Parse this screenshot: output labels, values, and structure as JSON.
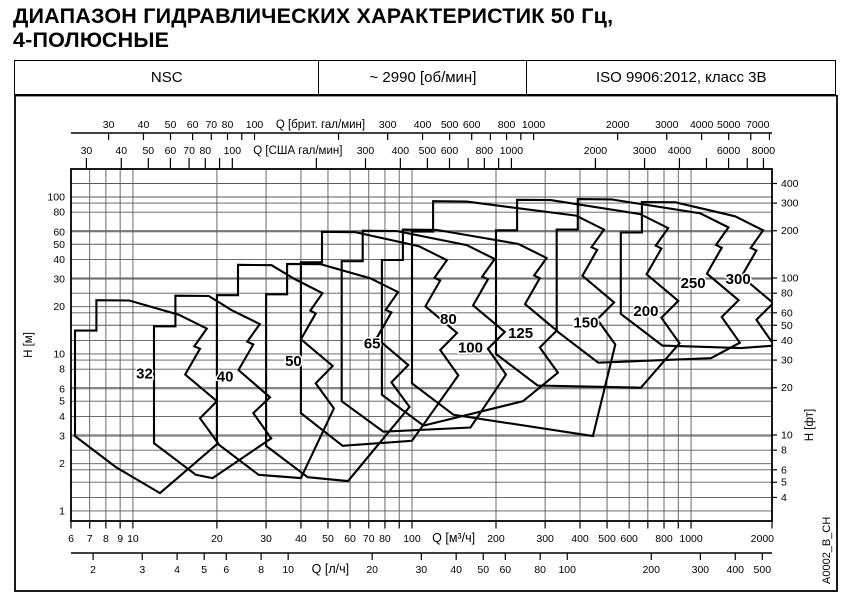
{
  "title": {
    "line1": "ДИАПАЗОН ГИДРАВЛИЧЕСКИХ ХАРАКТЕРИСТИК 50 Гц,",
    "line2": "4-ПОЛЮСНЫЕ"
  },
  "header": {
    "model": "NSC",
    "speed": "~ 2990 [об/мин]",
    "standard": "ISO 9906:2012, класс 3В"
  },
  "side_code": "A0002_B_CH",
  "colors": {
    "line": "#000000",
    "grid": "#5a5a5a",
    "bg": "#ffffff"
  },
  "chart_data": {
    "type": "area",
    "description": "Pump performance range envelopes, flow Q vs head H, log-log",
    "x_range_m3h": [
      6,
      1950
    ],
    "y_range_m": [
      0.863,
      150.8
    ],
    "flow_scales": [
      {
        "id": "imp_gpm",
        "label": "Q [брит. гал/мин]",
        "to_m3h": 0.27276,
        "side": "top",
        "row": 0,
        "title_at_m3h": 47,
        "ticks": [
          30,
          40,
          50,
          60,
          70,
          80,
          90,
          100,
          200,
          300,
          400,
          500,
          600,
          700,
          800,
          900,
          1000,
          2000,
          3000,
          4000,
          5000,
          6000,
          7000
        ],
        "labels": [
          30,
          40,
          50,
          60,
          70,
          80,
          100,
          300,
          400,
          500,
          600,
          800,
          1000,
          2000,
          3000,
          4000,
          5000,
          7000
        ]
      },
      {
        "id": "us_gpm",
        "label": "Q [США гал/мин]",
        "to_m3h": 0.22712,
        "side": "top",
        "row": 1,
        "title_at_m3h": 39,
        "ticks": [
          30,
          40,
          50,
          60,
          70,
          80,
          90,
          100,
          200,
          300,
          400,
          500,
          600,
          700,
          800,
          900,
          1000,
          2000,
          3000,
          4000,
          5000,
          6000,
          7000,
          8000
        ],
        "labels": [
          30,
          40,
          50,
          60,
          70,
          80,
          100,
          300,
          400,
          500,
          600,
          800,
          1000,
          2000,
          3000,
          4000,
          6000,
          8000
        ]
      },
      {
        "id": "m3h",
        "label": "Q [м³/ч]",
        "to_m3h": 1,
        "side": "bottom",
        "row": 0,
        "title_at_m3h": 141,
        "ticks": [
          6,
          7,
          8,
          9,
          10,
          20,
          30,
          40,
          50,
          60,
          70,
          80,
          90,
          100,
          200,
          300,
          400,
          500,
          600,
          700,
          800,
          900,
          1000,
          2000
        ],
        "labels": [
          6,
          7,
          8,
          9,
          10,
          20,
          30,
          40,
          50,
          60,
          70,
          80,
          100,
          200,
          300,
          400,
          500,
          600,
          800,
          1000,
          2000
        ]
      },
      {
        "id": "ls",
        "label": "Q [л/ч]",
        "to_m3h": 3.6,
        "side": "bottom",
        "row": 1,
        "title_at_m3h": 51,
        "ticks": [
          2,
          3,
          4,
          5,
          6,
          8,
          10,
          20,
          30,
          40,
          50,
          60,
          80,
          100,
          200,
          300,
          400,
          500
        ],
        "labels": [
          2,
          3,
          4,
          5,
          6,
          8,
          10,
          20,
          30,
          40,
          50,
          60,
          80,
          100,
          200,
          300,
          400,
          500
        ]
      }
    ],
    "head_scales": [
      {
        "id": "m",
        "label": "H [м]",
        "to_m": 1,
        "side": "left",
        "ticks": [
          1,
          2,
          3,
          4,
          5,
          6,
          8,
          10,
          20,
          30,
          40,
          50,
          60,
          80,
          100
        ]
      },
      {
        "id": "ft",
        "label": "H [фт]",
        "to_m": 0.3048,
        "side": "right",
        "ticks": [
          4,
          5,
          6,
          8,
          10,
          20,
          30,
          40,
          50,
          60,
          80,
          100,
          200,
          300,
          400
        ]
      }
    ],
    "gridlines": {
      "x_m3h": [
        6,
        7,
        8,
        9,
        10,
        20,
        30,
        40,
        50,
        60,
        70,
        80,
        90,
        100,
        200,
        300,
        400,
        500,
        600,
        700,
        800,
        900,
        1000
      ],
      "y_m": [
        1,
        2,
        3,
        4,
        5,
        6,
        8,
        10,
        20,
        30,
        40,
        50,
        60,
        80,
        100
      ],
      "y_ft": [
        4,
        5,
        6,
        8,
        10,
        20,
        30,
        40,
        50,
        60,
        80,
        100,
        200,
        300,
        400
      ]
    },
    "envelopes": [
      {
        "size": "32",
        "label_at": [
          11,
          7.0
        ],
        "points": [
          [
            6.2,
            3.0
          ],
          [
            6.2,
            14.1
          ],
          [
            7.4,
            14.1
          ],
          [
            7.4,
            22
          ],
          [
            9.7,
            21.9
          ],
          [
            14.6,
            17.8
          ],
          [
            18.4,
            14.5
          ],
          [
            16.6,
            11.2
          ],
          [
            17.4,
            10.8
          ],
          [
            15.4,
            7.4
          ],
          [
            20,
            5.0
          ],
          [
            17.4,
            3.9
          ],
          [
            20.2,
            2.7
          ],
          [
            12.5,
            1.3
          ],
          [
            8.7,
            1.9
          ]
        ]
      },
      {
        "size": "40",
        "label_at": [
          21.4,
          6.7
        ],
        "points": [
          [
            11.9,
            2.7
          ],
          [
            11.9,
            15.0
          ],
          [
            14.2,
            15.0
          ],
          [
            14.2,
            23.5
          ],
          [
            18.7,
            23.4
          ],
          [
            22.6,
            19.0
          ],
          [
            28.5,
            15.5
          ],
          [
            25.7,
            12.0
          ],
          [
            27.0,
            11.5
          ],
          [
            23.9,
            7.9
          ],
          [
            31,
            5.3
          ],
          [
            27.0,
            4.2
          ],
          [
            31.3,
            2.9
          ],
          [
            19.3,
            1.62
          ],
          [
            16.8,
            1.7
          ]
        ]
      },
      {
        "size": "50",
        "label_at": [
          37.6,
          8.4
        ],
        "points": [
          [
            20,
            2.7
          ],
          [
            20,
            23.7
          ],
          [
            23.8,
            23.7
          ],
          [
            23.8,
            37
          ],
          [
            31.4,
            36.8
          ],
          [
            38.0,
            30.0
          ],
          [
            47.8,
            24.4
          ],
          [
            43.2,
            18.9
          ],
          [
            45.2,
            18.1
          ],
          [
            40.0,
            12.4
          ],
          [
            52,
            8.4
          ],
          [
            45.2,
            6.5
          ],
          [
            52.5,
            4.5
          ],
          [
            40,
            1.62
          ],
          [
            28.2,
            1.7
          ]
        ]
      },
      {
        "size": "65",
        "label_at": [
          72,
          10.8
        ],
        "points": [
          [
            30,
            2.6
          ],
          [
            30,
            24.0
          ],
          [
            35.7,
            24.0
          ],
          [
            35.7,
            37.5
          ],
          [
            47.1,
            37.3
          ],
          [
            70.8,
            30.4
          ],
          [
            89.2,
            24.8
          ],
          [
            80.5,
            19.1
          ],
          [
            84.4,
            18.4
          ],
          [
            74.7,
            12.6
          ],
          [
            97,
            8.5
          ],
          [
            84.4,
            6.6
          ],
          [
            98.0,
            4.6
          ],
          [
            59,
            1.55
          ],
          [
            42.3,
            1.64
          ]
        ]
      },
      {
        "size": "80",
        "label_at": [
          135,
          15.5
        ],
        "points": [
          [
            40,
            4.2
          ],
          [
            40,
            38.4
          ],
          [
            47.6,
            38.4
          ],
          [
            47.6,
            60
          ],
          [
            62.8,
            59.7
          ],
          [
            105.9,
            48.6
          ],
          [
            133.4,
            39.6
          ],
          [
            120.4,
            30.6
          ],
          [
            126.2,
            29.4
          ],
          [
            111.7,
            20.1
          ],
          [
            145,
            13.6
          ],
          [
            126.2,
            10.6
          ],
          [
            146.5,
            7.3
          ],
          [
            100,
            2.8
          ],
          [
            56.4,
            2.6
          ]
        ]
      },
      {
        "size": "100",
        "label_at": [
          162,
          10.2
        ],
        "points": [
          [
            56,
            5.0
          ],
          [
            56,
            39.0
          ],
          [
            66.6,
            39.0
          ],
          [
            66.6,
            61
          ],
          [
            87.9,
            60.7
          ],
          [
            157,
            49.4
          ],
          [
            197.8,
            40.3
          ],
          [
            178.5,
            31.1
          ],
          [
            187.1,
            29.9
          ],
          [
            165.6,
            20.4
          ],
          [
            215,
            13.8
          ],
          [
            187.1,
            10.8
          ],
          [
            217.2,
            7.4
          ],
          [
            162,
            3.4
          ],
          [
            79,
            3.2
          ]
        ]
      },
      {
        "size": "125",
        "label_at": [
          245,
          12.6
        ],
        "points": [
          [
            78,
            5.5
          ],
          [
            78,
            39.7
          ],
          [
            92.8,
            39.7
          ],
          [
            92.8,
            62
          ],
          [
            122.5,
            61.7
          ],
          [
            240.9,
            50.2
          ],
          [
            303.6,
            40.9
          ],
          [
            273.9,
            31.6
          ],
          [
            287.1,
            30.4
          ],
          [
            254.1,
            20.8
          ],
          [
            330,
            14.1
          ],
          [
            287.1,
            11.0
          ],
          [
            333.3,
            7.6
          ],
          [
            250,
            5.0
          ],
          [
            110,
            3.5
          ]
        ]
      },
      {
        "size": "150",
        "label_at": [
          420,
          14.7
        ],
        "points": [
          [
            100,
            6.5
          ],
          [
            100,
            60.2
          ],
          [
            119,
            60.2
          ],
          [
            119,
            94
          ],
          [
            157,
            93.5
          ],
          [
            386.9,
            76.1
          ],
          [
            487.6,
            62.0
          ],
          [
            439.9,
            47.9
          ],
          [
            461.1,
            46.1
          ],
          [
            408.1,
            31.5
          ],
          [
            530,
            21.3
          ],
          [
            461.1,
            16.6
          ],
          [
            535.3,
            11.5
          ],
          [
            445,
            3.0
          ],
          [
            141,
            4.1
          ]
        ]
      },
      {
        "size": "200",
        "label_at": [
          689,
          17.5
        ],
        "points": [
          [
            200,
            10
          ],
          [
            200,
            61.4
          ],
          [
            238,
            61.4
          ],
          [
            238,
            96
          ],
          [
            314,
            95.5
          ],
          [
            657,
            77.8
          ],
          [
            828,
            63.4
          ],
          [
            747,
            49.0
          ],
          [
            783,
            47.0
          ],
          [
            693,
            32.2
          ],
          [
            900,
            21.8
          ],
          [
            783,
            17.0
          ],
          [
            909,
            11.7
          ],
          [
            661,
            6.1
          ],
          [
            282,
            6.3
          ]
        ]
      },
      {
        "size": "250",
        "label_at": [
          1017,
          26.4
        ],
        "points": [
          [
            330,
            14
          ],
          [
            330,
            62.1
          ],
          [
            392.7,
            62.1
          ],
          [
            392.7,
            97
          ],
          [
            518.1,
            96.5
          ],
          [
            1080.4,
            78.6
          ],
          [
            1361.6,
            64.0
          ],
          [
            1228.4,
            49.5
          ],
          [
            1287.6,
            47.5
          ],
          [
            1139.6,
            32.5
          ],
          [
            1480,
            22.0
          ],
          [
            1287.6,
            17.2
          ],
          [
            1494.8,
            11.8
          ],
          [
            1179,
            9.4
          ],
          [
            465.3,
            8.8
          ]
        ]
      },
      {
        "size": "300",
        "label_at": [
          1475,
          27.9
        ],
        "points": [
          [
            560,
            18
          ],
          [
            560,
            59.5
          ],
          [
            666.4,
            59.5
          ],
          [
            666.4,
            93
          ],
          [
            879.2,
            92.5
          ],
          [
            1438.1,
            75.3
          ],
          [
            1812.4,
            61.4
          ],
          [
            1635.1,
            47.4
          ],
          [
            1713.9,
            45.6
          ],
          [
            1516.9,
            31.2
          ],
          [
            1970,
            21.1
          ],
          [
            1713.9,
            16.5
          ],
          [
            1989.7,
            11.3
          ],
          [
            1509,
            10.9
          ],
          [
            789.6,
            11.3
          ]
        ]
      }
    ]
  }
}
